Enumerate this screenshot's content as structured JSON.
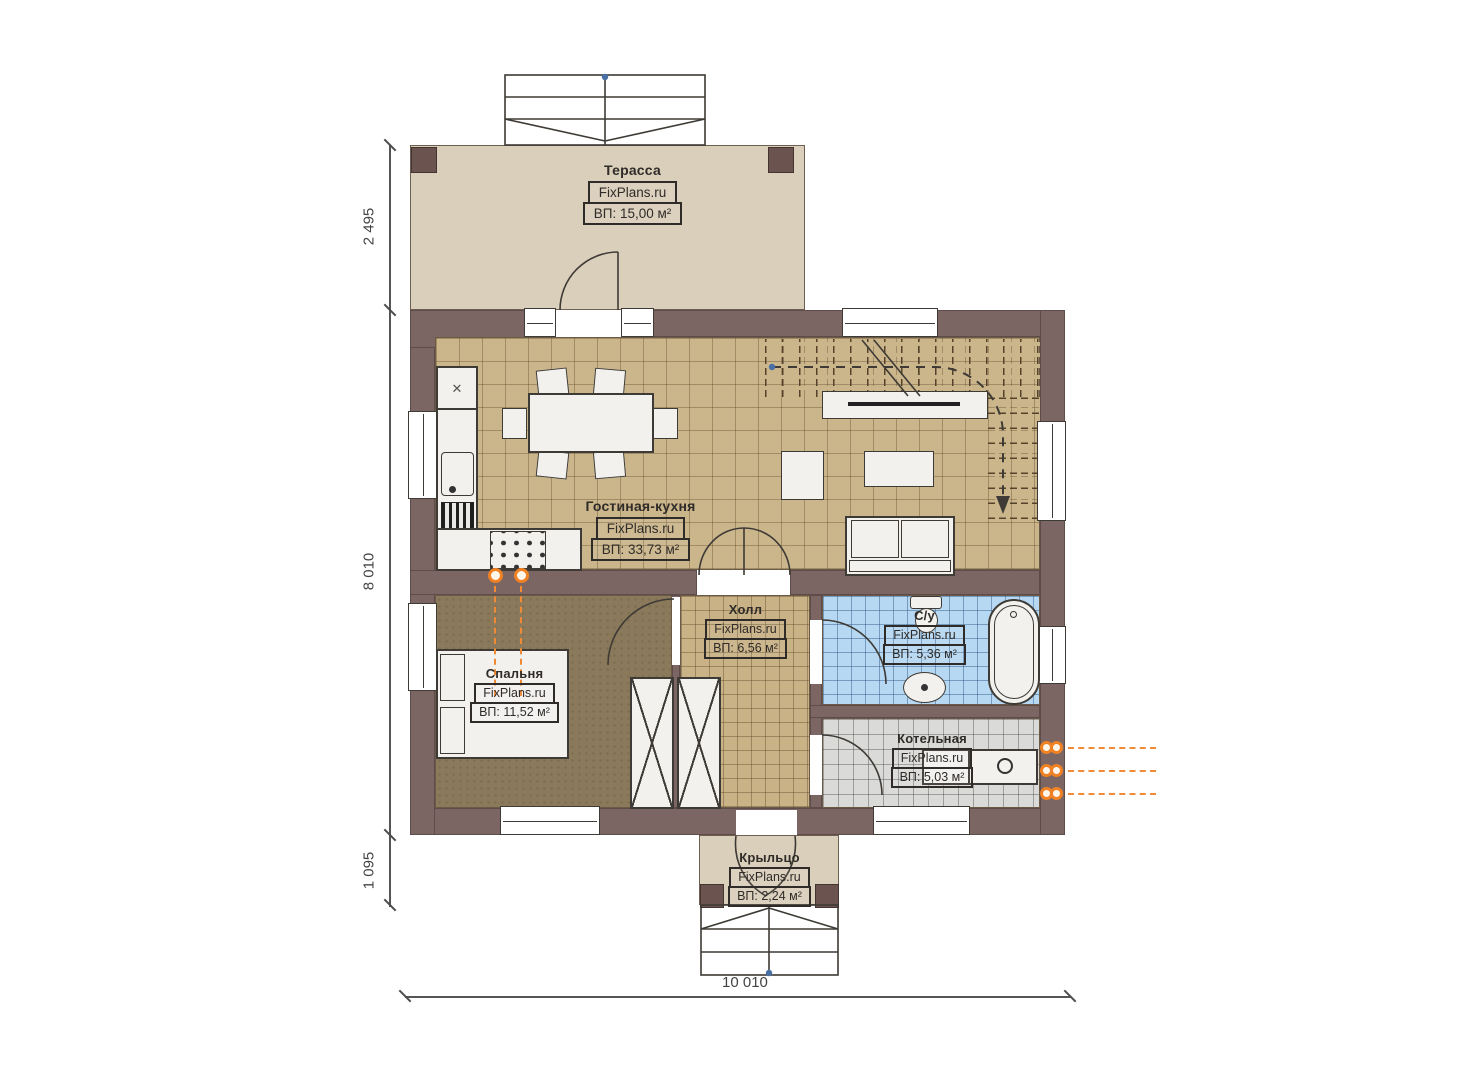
{
  "watermark": "FixPlans.ru",
  "rooms": {
    "terrace": {
      "name": "Терасса",
      "brand": "FixPlans.ru",
      "area": "ВП: 15,00 м²"
    },
    "living": {
      "name": "Гостиная-кухня",
      "brand": "FixPlans.ru",
      "area": "ВП: 33,73 м²"
    },
    "hall": {
      "name": "Холл",
      "brand": "FixPlans.ru",
      "area": "ВП: 6,56 м²"
    },
    "bathroom": {
      "name": "С/у",
      "brand": "FixPlans.ru",
      "area": "ВП: 5,36 м²"
    },
    "bedroom": {
      "name": "Спальня",
      "brand": "FixPlans.ru",
      "area": "ВП: 11,52 м²"
    },
    "boiler": {
      "name": "Котельная",
      "brand": "FixPlans.ru",
      "area": "ВП: 5,03 м²"
    },
    "porch": {
      "name": "Крыльцо",
      "brand": "FixPlans.ru",
      "area": "ВП: 2,24 м²"
    }
  },
  "dimensions": {
    "terrace_depth": "2 495",
    "house_depth": "8 010",
    "porch_depth": "1 095",
    "house_width": "10 010"
  },
  "icons": {
    "fridge_cross": "✕"
  },
  "colors": {
    "wall": "#7b6663",
    "terrace_floor": "#dacfba",
    "living_tile": "#cbb68c",
    "bedroom_floor": "#8a795a",
    "bathroom_tile": "#b7d8f2",
    "boiler_tile": "#dadad8",
    "utility_accent": "#f08224"
  }
}
